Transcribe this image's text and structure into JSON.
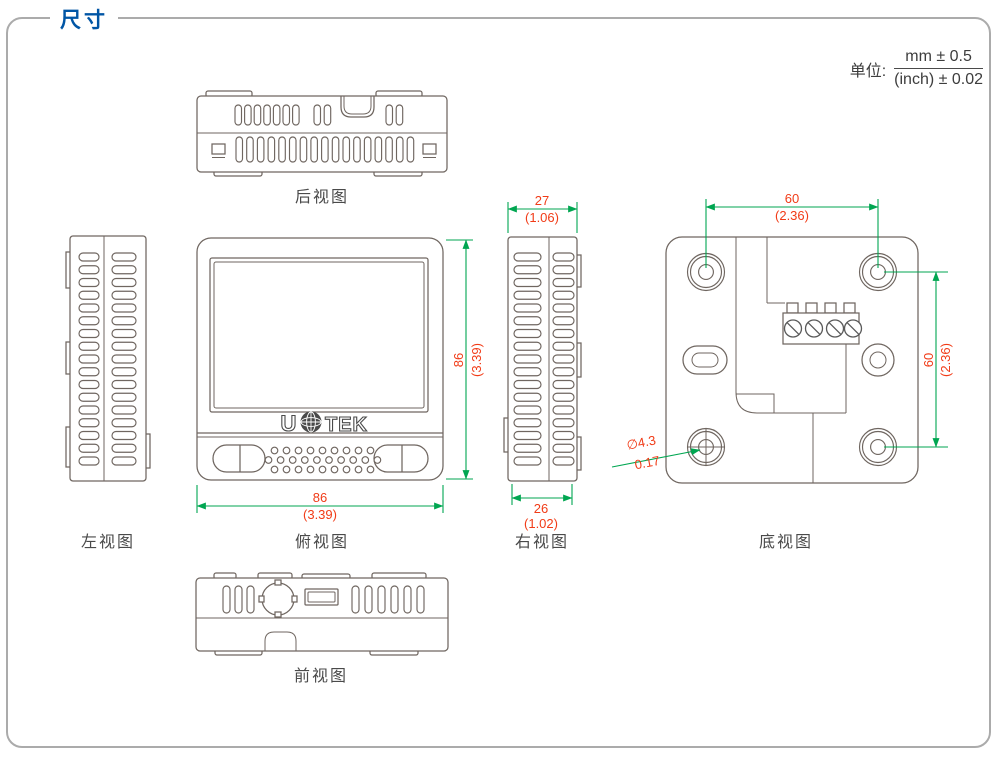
{
  "page": {
    "title": "尺寸"
  },
  "units": {
    "label": "单位:",
    "mm": "mm ± 0.5",
    "inch": "(inch) ± 0.02"
  },
  "views": {
    "rear": {
      "label": "后视图"
    },
    "left": {
      "label": "左视图"
    },
    "top": {
      "label": "俯视图"
    },
    "right": {
      "label": "右视图"
    },
    "bottom": {
      "label": "底视图"
    },
    "front": {
      "label": "前视图"
    }
  },
  "brand": {
    "prefix": "U",
    "suffix": "TEK",
    "icon": "globe-icon"
  },
  "dimensions": {
    "width": {
      "mm": "86",
      "inch": "(3.39)"
    },
    "height": {
      "mm": "86",
      "inch": "(3.39)"
    },
    "depth_top": {
      "mm": "27",
      "inch": "(1.06)"
    },
    "depth_bottom": {
      "mm": "26",
      "inch": "(1.02)"
    },
    "hole_spacing_horizontal": {
      "mm": "60",
      "inch": "(2.36)"
    },
    "hole_spacing_vertical": {
      "mm": "60",
      "inch": "(2.36)"
    },
    "hole_diameter": {
      "mm": "∅4.3",
      "inch": "0.17"
    }
  },
  "colors": {
    "accent_blue": "#0055A5",
    "dimension_line_green": "#00A651",
    "dimension_text_red": "#F13B17",
    "drawing_line_gray": "#6F6660"
  }
}
